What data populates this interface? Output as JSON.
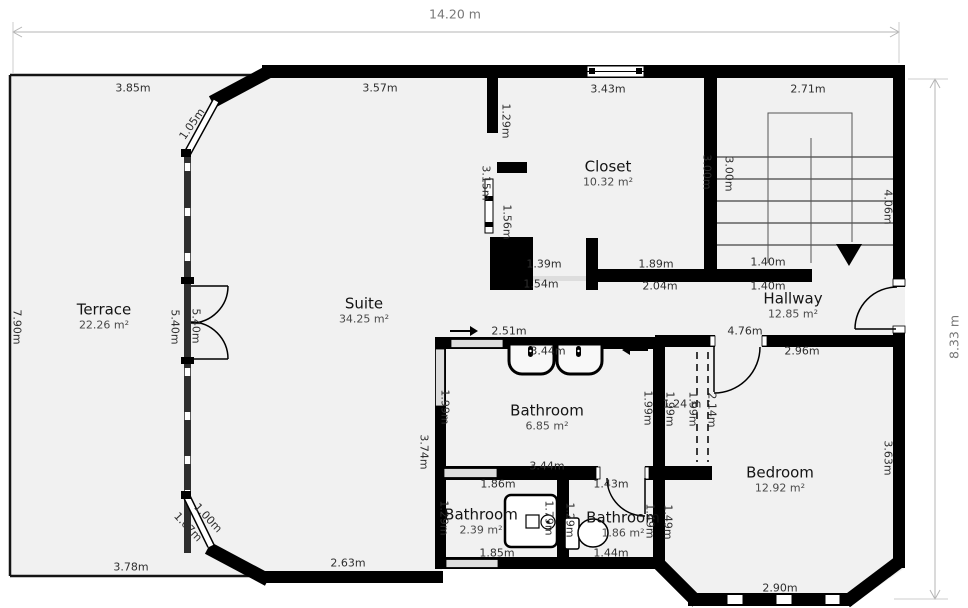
{
  "title": "Floor plan",
  "colors": {
    "wall": "#000000",
    "floor": "#f1f1f1",
    "background": "#ffffff",
    "dimension_line": "#b5b5b5",
    "label_text": "#2e2e2e"
  },
  "rooms": {
    "terrace": {
      "name": "Terrace",
      "area": "22.26 m²"
    },
    "suite": {
      "name": "Suite",
      "area": "34.25 m²"
    },
    "closet": {
      "name": "Closet",
      "area": "10.32 m²"
    },
    "hallway": {
      "name": "Hallway",
      "area": "12.85 m²"
    },
    "bathroom_main": {
      "name": "Bathroom",
      "area": "6.85 m²"
    },
    "bedroom": {
      "name": "Bedroom",
      "area": "12.92 m²"
    },
    "bathroom_left": {
      "name": "Bathroom",
      "area": "2.39 m²"
    },
    "bathroom_right": {
      "name": "Bathroom",
      "area": "1.86 m²"
    }
  },
  "labels": [
    "14.20 m",
    "8.33 m",
    "3.85m",
    "3.57m",
    "3.43m",
    "2.71m",
    "1.05m",
    "1.29m",
    "3.15m",
    "1.56m",
    "3.00m",
    "3.00m",
    "4.06m",
    "1.39m",
    "1.89m",
    "1.40m",
    "1.54m",
    "2.04m",
    "1.40m",
    "2.51m",
    "4.76m",
    "3.44m",
    "2.96m",
    "7.90m",
    "5.40m",
    "5.40m",
    "1.99m",
    "3.74m",
    "1.99m",
    "1.99m",
    "1.24 m",
    "1.99m",
    "2.14m",
    "3.44m",
    "1.86m",
    "1.43m",
    "1.29m",
    "1.79m",
    "1.29m",
    "1.49m",
    "1.49m",
    "3.63m",
    "1.85m",
    "1.44m",
    "2.63m",
    "3.78m",
    "2.90m",
    "1.07m",
    "1.00m"
  ]
}
